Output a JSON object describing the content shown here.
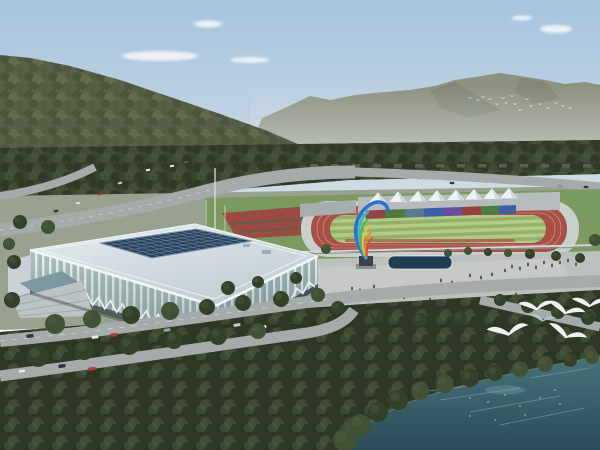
{
  "alt_text": "Aerial architectural rendering: white lattice gymnasium with dark glass skylight roof, outdoor athletics track with white canopy tents and rainbow stand wall, colorful flame sculpture, plaza with pond and people, curving roads with cars, forested hills, distant river, waterfront with flying white egrets",
  "palette": {
    "sky_top": "#a6c3de",
    "sky_mid": "#c3d4e2",
    "sky_horizon": "#dde4e2",
    "cloud": "#f4f7f9",
    "mountain": "#8d9180",
    "mountain_shadow": "#767b6c",
    "haze": "#dfe5e3",
    "hill_base": "#5a614a",
    "hill_tree_dark": "#4b523a",
    "hill_tree_mid": "#666e50",
    "hill_tree_deep": "#515941",
    "river": "#b5c8c4",
    "river_light": "#cfdeda",
    "forest_base": "#39442f",
    "forest_tree_dark": "#2e3825",
    "forest_tree_mid": "#434f35",
    "forest_tree_light": "#4f5c3f",
    "greenbelt_base": "#2c3624",
    "ground": "#98a28e",
    "grass": "#7b9a5f",
    "road": "#a5abab",
    "road_line": "#e8ecec",
    "parking": "#a8aeac",
    "facility_block": "#596052",
    "track_apron": "#c9cfcb",
    "track_red": "#a85045",
    "infield_light": "#b2cb84",
    "infield_dark": "#93b16c",
    "flowerbed": "#9c4a44",
    "stand_gray": "#b6bcbe",
    "tent_white": "#eef2f3",
    "tent_shade": "#cfd7da",
    "fence_light": "#d2d8d6",
    "plaza": "#bdc1be",
    "plaza_light": "#cccfc9",
    "pond": "#1f3e52",
    "people": "#2b3137",
    "pole": "#d5dadc",
    "roof_light": "#e6edf0",
    "roof_dark": "#bfccd1",
    "roof_edge": "#f2f6f7",
    "skylight": "#2b4560",
    "skylight_grid": "#7d98ad",
    "facade_glass": "#a9c2bd",
    "facade_glass_shade": "#9db4b4",
    "facade_rib": "#eef3f4",
    "facade_dark_band": "#4e5c5e",
    "entrance_canopy": "#7e98a2",
    "entrance_steps": "#bcc3c4",
    "water_top": "#477379",
    "water_bottom": "#2b4b57",
    "water_streak": "#7fa6a8",
    "bird_white": "#f6f9f9",
    "bird_gray": "#b9c2c4",
    "tree_dark": "#33402a",
    "tree_mid": "#415136",
    "tree_light": "#566846"
  },
  "clouds": [
    [
      160,
      56,
      38,
      5
    ],
    [
      208,
      24,
      14,
      3.5
    ],
    [
      556,
      29,
      16,
      4
    ],
    [
      522,
      18,
      10,
      2.5
    ],
    [
      250,
      60,
      20,
      3
    ]
  ],
  "small_birds": [
    [
      470,
      98
    ],
    [
      478,
      100
    ],
    [
      483,
      97
    ],
    [
      490,
      99
    ],
    [
      497,
      104
    ],
    [
      503,
      98
    ],
    [
      506,
      103
    ],
    [
      512,
      96
    ],
    [
      515,
      104
    ],
    [
      520,
      110
    ],
    [
      527,
      99
    ],
    [
      531,
      106
    ],
    [
      540,
      104
    ],
    [
      548,
      108
    ],
    [
      556,
      103
    ],
    [
      563,
      106
    ],
    [
      570,
      108
    ]
  ],
  "large_birds": [
    {
      "x": 537,
      "y": 308,
      "s": 1.1,
      "r": -10
    },
    {
      "x": 566,
      "y": 312,
      "s": 1.2,
      "r": 8
    },
    {
      "x": 590,
      "y": 305,
      "s": 1.1,
      "r": -5
    },
    {
      "x": 509,
      "y": 333,
      "s": 1.3,
      "r": -15
    },
    {
      "x": 567,
      "y": 336,
      "s": 1.25,
      "r": 12
    },
    {
      "x": 543,
      "y": 320,
      "s": 0.8,
      "r": 0,
      "c": "#b9c2c4"
    }
  ],
  "band_segments": [
    {
      "w": 19,
      "color": "#8e4449"
    },
    {
      "w": 20,
      "color": "#4e7a40"
    },
    {
      "w": 19,
      "color": "#5a7a8e"
    },
    {
      "w": 20,
      "color": "#3c5fa6"
    },
    {
      "w": 18,
      "color": "#6b4c9c"
    },
    {
      "w": 19,
      "color": "#94403c"
    },
    {
      "w": 18,
      "color": "#4c7e44"
    },
    {
      "w": 17,
      "color": "#3c5fa6"
    }
  ],
  "tents": {
    "xs": [
      378,
      398,
      418,
      437,
      456,
      474,
      492,
      509
    ],
    "half_w": 9.5,
    "peak_h": 11
  },
  "skylight": {
    "cols": 12,
    "rows": 6,
    "corners": [
      [
        100,
        243
      ],
      [
        196,
        229
      ],
      [
        252,
        241
      ],
      [
        152,
        258
      ]
    ]
  },
  "facility_blocks": {
    "y": 164,
    "start": 310,
    "step": 21,
    "count": 14,
    "w": 8,
    "h": 3.5
  },
  "cars_front": [
    {
      "x": 30,
      "y": 336,
      "r": -7,
      "c": "#2b3240"
    },
    {
      "x": 95,
      "y": 337,
      "r": -8,
      "c": "#e9eaea"
    },
    {
      "x": 114,
      "y": 335,
      "r": -8,
      "c": "#b23a31"
    },
    {
      "x": 167,
      "y": 330,
      "r": -8,
      "c": "#98a1a6"
    },
    {
      "x": 237,
      "y": 325,
      "r": -9,
      "c": "#c6cccd"
    },
    {
      "x": 263,
      "y": 327,
      "r": -8,
      "c": "#e9eaea"
    },
    {
      "x": 290,
      "y": 323,
      "r": -8,
      "c": "#343b44"
    },
    {
      "x": 22,
      "y": 371,
      "r": -7,
      "c": "#e9eaea"
    },
    {
      "x": 62,
      "y": 366,
      "r": -8,
      "c": "#2b3240"
    },
    {
      "x": 92,
      "y": 369,
      "r": -8,
      "c": "#b23a31"
    }
  ],
  "cars_back": [
    {
      "x": 148,
      "y": 170,
      "r": -11,
      "c": "#e9eaea"
    },
    {
      "x": 158,
      "y": 173,
      "r": -11,
      "c": "#343b44"
    },
    {
      "x": 120,
      "y": 183,
      "r": -11,
      "c": "#c6cccd"
    },
    {
      "x": 100,
      "y": 194,
      "r": -11,
      "c": "#b23a31"
    },
    {
      "x": 78,
      "y": 203,
      "r": -11,
      "c": "#e9eaea"
    },
    {
      "x": 56,
      "y": 211,
      "r": -11,
      "c": "#343b44"
    },
    {
      "x": 172,
      "y": 166,
      "r": -11,
      "c": "#e9eaea"
    },
    {
      "x": 186,
      "y": 162,
      "r": -11,
      "c": "#5a646a"
    }
  ],
  "cars_far": [
    {
      "x": 420,
      "y": 181,
      "r": 2,
      "c": "#e9eaea"
    },
    {
      "x": 452,
      "y": 183,
      "r": 2,
      "c": "#343b44"
    },
    {
      "x": 484,
      "y": 184,
      "r": 2,
      "c": "#e9eaea"
    },
    {
      "x": 560,
      "y": 186,
      "r": 2,
      "c": "#98a1a6"
    },
    {
      "x": 586,
      "y": 187,
      "r": 2,
      "c": "#343b44"
    }
  ],
  "cars_parking": [
    {
      "x": 524,
      "y": 199,
      "c": "#b23a31"
    },
    {
      "x": 532,
      "y": 199,
      "c": "#2e4f9e"
    },
    {
      "x": 540,
      "y": 199,
      "c": "#e9eaea"
    },
    {
      "x": 548,
      "y": 199,
      "c": "#d4b23a"
    },
    {
      "x": 556,
      "y": 199,
      "c": "#98a1a6"
    },
    {
      "x": 564,
      "y": 199,
      "c": "#343b44"
    },
    {
      "x": 572,
      "y": 199,
      "c": "#e9eaea"
    },
    {
      "x": 580,
      "y": 199,
      "c": "#b23a31"
    },
    {
      "x": 588,
      "y": 199,
      "c": "#2e4f9e"
    },
    {
      "x": 520,
      "y": 211,
      "c": "#e9eaea"
    },
    {
      "x": 529,
      "y": 211,
      "c": "#343b44"
    },
    {
      "x": 538,
      "y": 211,
      "c": "#b23a31"
    },
    {
      "x": 547,
      "y": 211,
      "c": "#98a1a6"
    },
    {
      "x": 556,
      "y": 211,
      "c": "#e9eaea"
    },
    {
      "x": 565,
      "y": 211,
      "c": "#2e4f9e"
    }
  ],
  "trees": [
    [
      55,
      324,
      10
    ],
    [
      92,
      319,
      9
    ],
    [
      131,
      315,
      9
    ],
    [
      170,
      311,
      9
    ],
    [
      207,
      307,
      8
    ],
    [
      243,
      303,
      8
    ],
    [
      281,
      299,
      8
    ],
    [
      318,
      295,
      7
    ],
    [
      38,
      356,
      11
    ],
    [
      84,
      350,
      10
    ],
    [
      129,
      345,
      10
    ],
    [
      174,
      340,
      9
    ],
    [
      218,
      336,
      9
    ],
    [
      258,
      331,
      8
    ],
    [
      12,
      300,
      8
    ],
    [
      14,
      262,
      7
    ],
    [
      9,
      244,
      6
    ],
    [
      20,
      222,
      7
    ],
    [
      48,
      227,
      7
    ],
    [
      228,
      288,
      7
    ],
    [
      258,
      282,
      6
    ],
    [
      296,
      278,
      6
    ],
    [
      338,
      308,
      7
    ],
    [
      377,
      315,
      7
    ],
    [
      420,
      320,
      7
    ],
    [
      460,
      318,
      7
    ],
    [
      500,
      300,
      6
    ],
    [
      528,
      306,
      7
    ],
    [
      558,
      312,
      7
    ],
    [
      588,
      318,
      7
    ],
    [
      326,
      249,
      5
    ],
    [
      448,
      253,
      4
    ],
    [
      468,
      251,
      4
    ],
    [
      488,
      252,
      4
    ],
    [
      508,
      253,
      4
    ],
    [
      530,
      254,
      5
    ],
    [
      556,
      256,
      5
    ],
    [
      580,
      258,
      5
    ],
    [
      595,
      240,
      6
    ]
  ],
  "shore_trees": [
    [
      345,
      440,
      12
    ],
    [
      360,
      425,
      11
    ],
    [
      378,
      412,
      10
    ],
    [
      398,
      400,
      10
    ],
    [
      420,
      391,
      9
    ],
    [
      445,
      384,
      9
    ],
    [
      470,
      378,
      9
    ],
    [
      495,
      373,
      8
    ],
    [
      520,
      369,
      8
    ],
    [
      545,
      364,
      8
    ],
    [
      570,
      360,
      7
    ],
    [
      592,
      357,
      7
    ]
  ],
  "people": [
    [
      352,
      290
    ],
    [
      360,
      292
    ],
    [
      374,
      288
    ],
    [
      391,
      295
    ],
    [
      404,
      299
    ],
    [
      414,
      295
    ],
    [
      430,
      301
    ],
    [
      441,
      282
    ],
    [
      452,
      284
    ],
    [
      470,
      277
    ],
    [
      481,
      279
    ],
    [
      492,
      276
    ],
    [
      505,
      272
    ],
    [
      512,
      268
    ],
    [
      520,
      270
    ],
    [
      528,
      266
    ],
    [
      536,
      269
    ],
    [
      544,
      264
    ],
    [
      552,
      267
    ],
    [
      560,
      264
    ],
    [
      568,
      262
    ],
    [
      576,
      266
    ],
    [
      318,
      304
    ],
    [
      484,
      300
    ],
    [
      500,
      298
    ],
    [
      516,
      296
    ]
  ],
  "water_streaks": [
    [
      440,
      400,
      520,
      388
    ],
    [
      470,
      412,
      560,
      396
    ],
    [
      500,
      425,
      585,
      408
    ],
    [
      420,
      392,
      470,
      386
    ],
    [
      530,
      378,
      590,
      368
    ]
  ],
  "sparkles": [
    [
      470,
      398
    ],
    [
      488,
      402
    ],
    [
      505,
      395
    ],
    [
      520,
      406
    ],
    [
      540,
      398
    ],
    [
      555,
      390
    ],
    [
      470,
      416
    ],
    [
      495,
      420
    ],
    [
      525,
      415
    ],
    [
      560,
      404
    ]
  ],
  "sculpture_colors": [
    "#2a6fd4",
    "#35b8d8",
    "#52b848",
    "#e8c43a",
    "#e8883a",
    "#d4483a"
  ]
}
